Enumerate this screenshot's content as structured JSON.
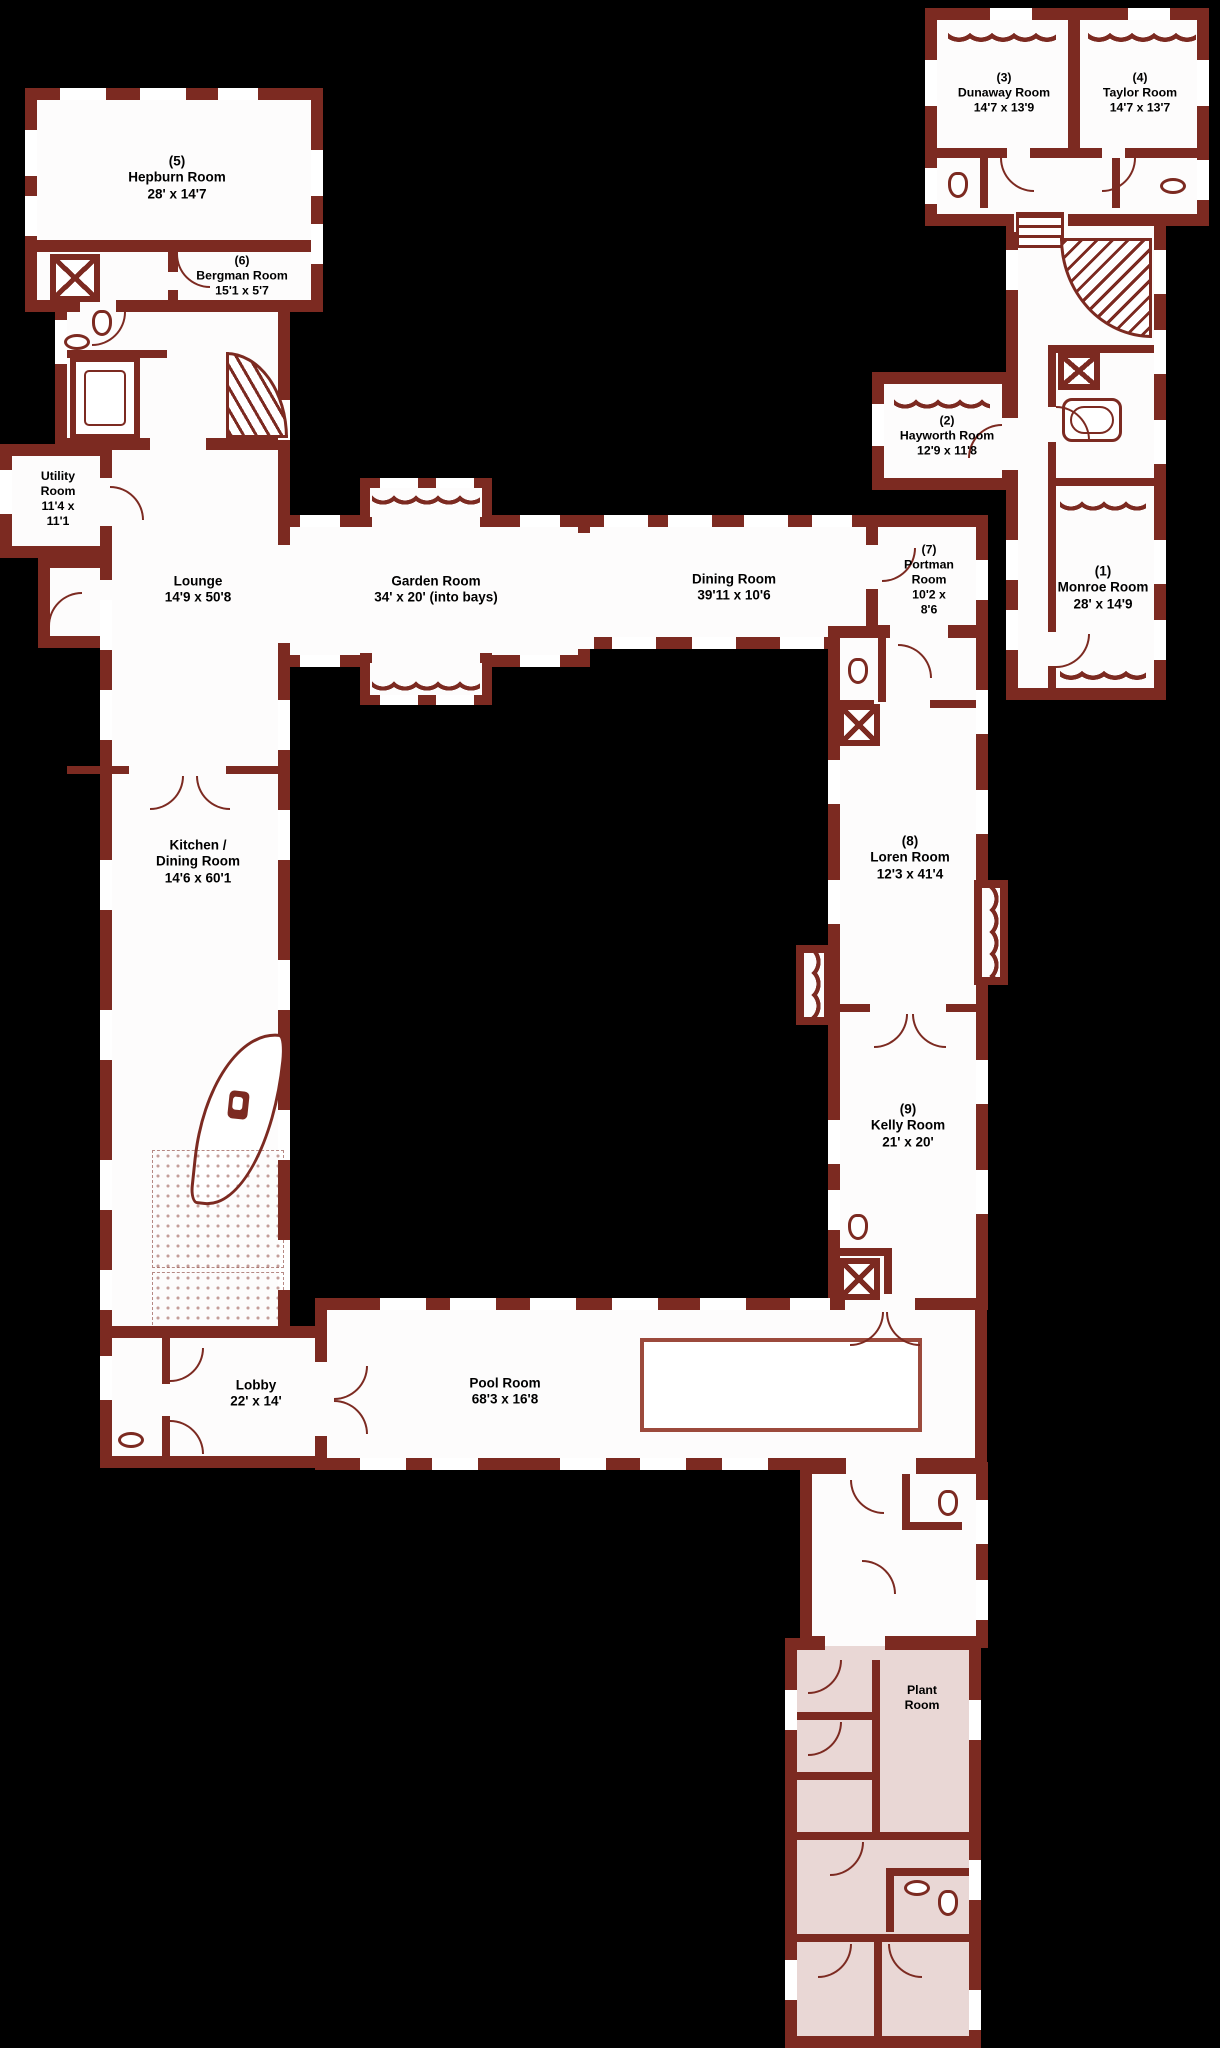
{
  "figure_type": "estate-floor-plan",
  "colors": {
    "wall": "#7c2a21",
    "background": "#000000",
    "room_fill": "#fdfcfc",
    "annex_fill": "#e9d7d5",
    "pool_outline": "#9c4a3c",
    "label_text": "#000000"
  },
  "rooms": {
    "hepburn": {
      "label": "(5)\nHepburn Room\n28' x 14'7"
    },
    "bergman": {
      "label": "(6)\nBergman Room\n15'1 x 5'7"
    },
    "utility": {
      "label": "Utility\nRoom\n11'4 x\n11'1"
    },
    "lounge": {
      "label": "Lounge\n14'9 x 50'8"
    },
    "garden": {
      "label": "Garden Room\n34' x 20' (into bays)"
    },
    "dining": {
      "label": "Dining Room\n39'11 x 10'6"
    },
    "portman": {
      "label": "(7)\nPortman\nRoom\n10'2 x\n8'6"
    },
    "monroe": {
      "label": "(1)\nMonroe Room\n28' x 14'9"
    },
    "hayworth": {
      "label": "(2)\nHayworth Room\n12'9 x 11'8"
    },
    "dunaway": {
      "label": "(3)\nDunaway Room\n14'7 x 13'9"
    },
    "taylor": {
      "label": "(4)\nTaylor Room\n14'7 x 13'7"
    },
    "loren": {
      "label": "(8)\nLoren Room\n12'3 x 41'4"
    },
    "kelly": {
      "label": "(9)\nKelly Room\n21' x 20'"
    },
    "kitchen": {
      "label": "Kitchen /\nDining Room\n14'6 x 60'1"
    },
    "lobby": {
      "label": "Lobby\n22' x 14'"
    },
    "pool": {
      "label": "Pool Room\n68'3 x 16'8"
    },
    "plant": {
      "label": "Plant\nRoom"
    }
  }
}
